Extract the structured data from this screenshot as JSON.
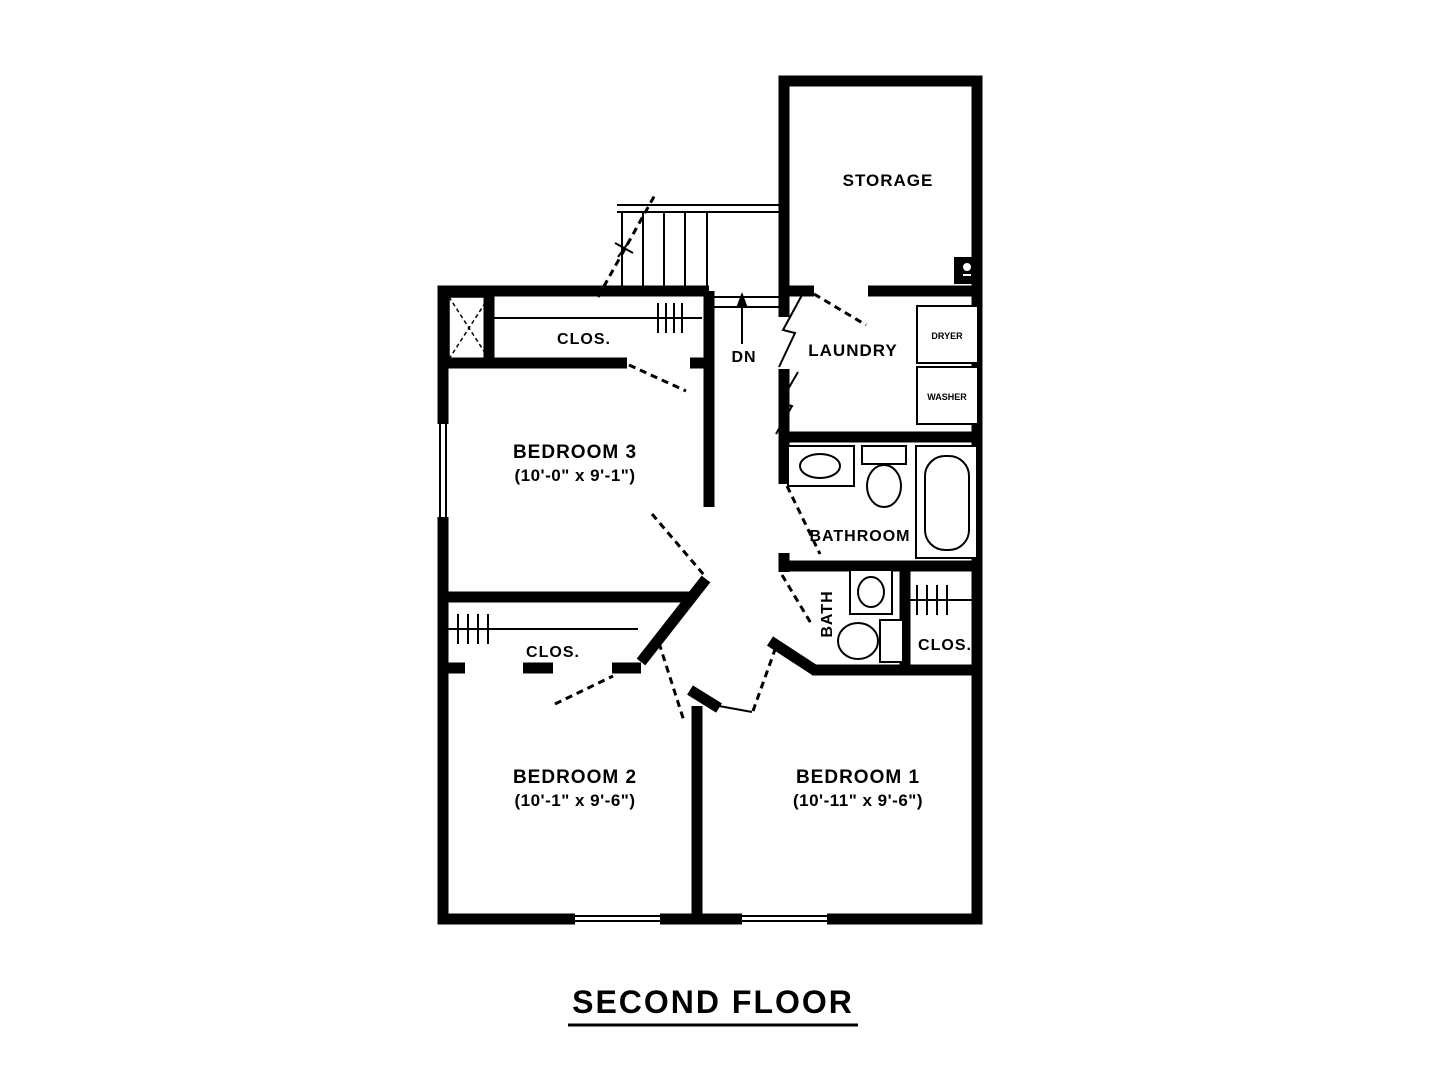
{
  "title": "SECOND FLOOR",
  "rooms": {
    "storage": {
      "label": "STORAGE"
    },
    "laundry": {
      "label": "LAUNDRY"
    },
    "bathroom": {
      "label": "BATHROOM"
    },
    "bath": {
      "label": "BATH"
    },
    "bedroom3": {
      "label": "BEDROOM 3",
      "dims": "(10'-0\" x 9'-1\")"
    },
    "bedroom2": {
      "label": "BEDROOM 2",
      "dims": "(10'-1\" x 9'-6\")"
    },
    "bedroom1": {
      "label": "BEDROOM 1",
      "dims": "(10'-11\" x 9'-6\")"
    },
    "closet_bedroom3": {
      "label": "CLOS."
    },
    "closet_bedroom2": {
      "label": "CLOS."
    },
    "closet_bedroom1": {
      "label": "CLOS."
    }
  },
  "appliances": {
    "dryer": {
      "label": "DRYER"
    },
    "washer": {
      "label": "WASHER"
    }
  },
  "stairs": {
    "down_label": "DN"
  },
  "colors": {
    "wall": "#000000",
    "background": "#ffffff"
  }
}
